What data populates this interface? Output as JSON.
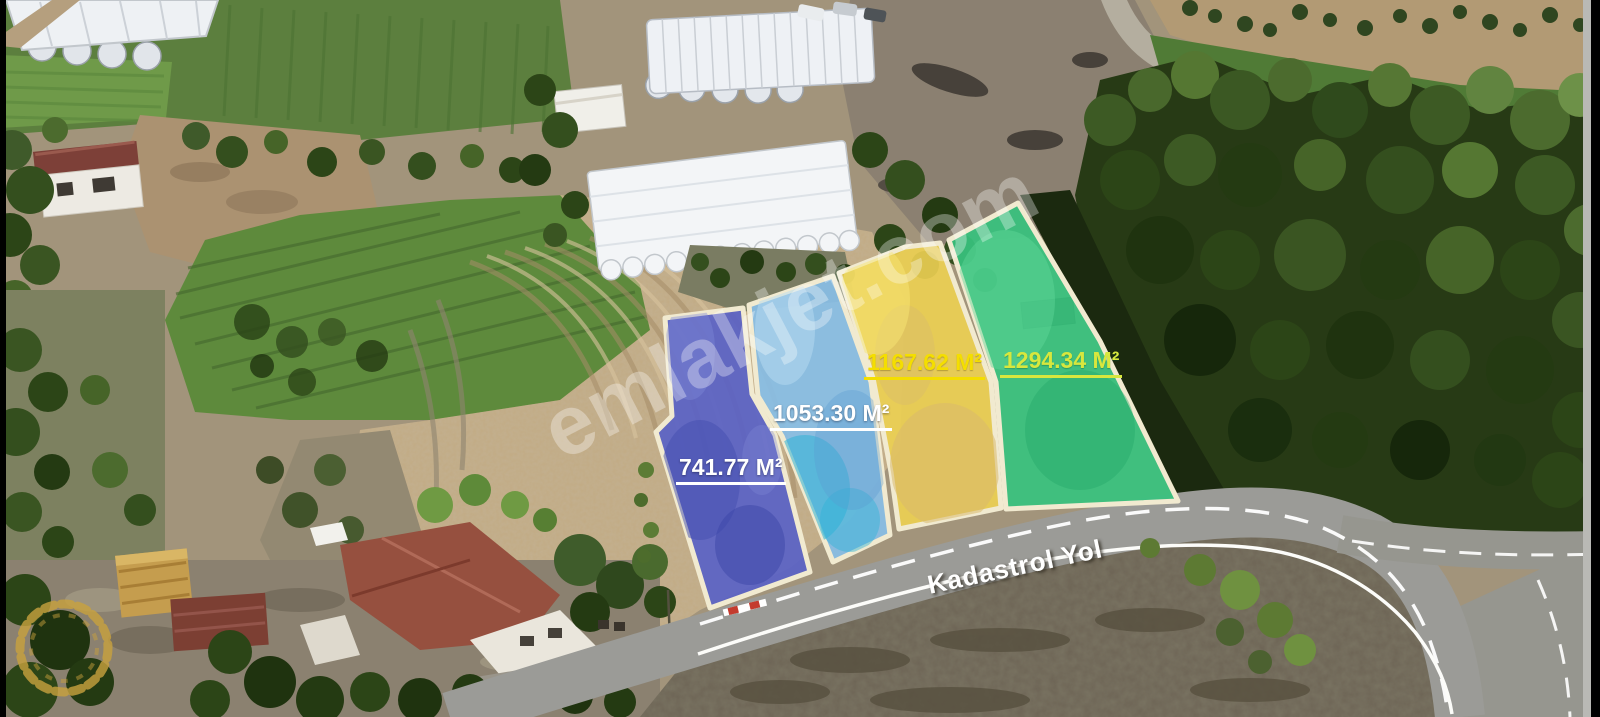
{
  "watermark": {
    "text": "emlakjet.com",
    "color": "#ffffff"
  },
  "road": {
    "name": "Kadastrol Yol",
    "surface_color": "#9b9b97",
    "marking_color": "#ffffff"
  },
  "parcels": [
    {
      "area": "741.77 M²",
      "fill": "#5a62c6",
      "label_color": "#ffffff"
    },
    {
      "area": "1053.30 M²",
      "fill": "#88bee6",
      "label_color": "#ffffff"
    },
    {
      "area": "1167.62 M²",
      "fill": "#eccf52",
      "label_color": "#f4de00"
    },
    {
      "area": "1294.34 M²",
      "fill": "#37c27e",
      "label_color": "#d7e73e"
    }
  ],
  "colors": {
    "parcel_border": "#f1ead0",
    "wreath_gold": "#c9a23e",
    "frame": "#000000"
  },
  "icons": {
    "bottom_left_logo": "laurel-wreath"
  }
}
